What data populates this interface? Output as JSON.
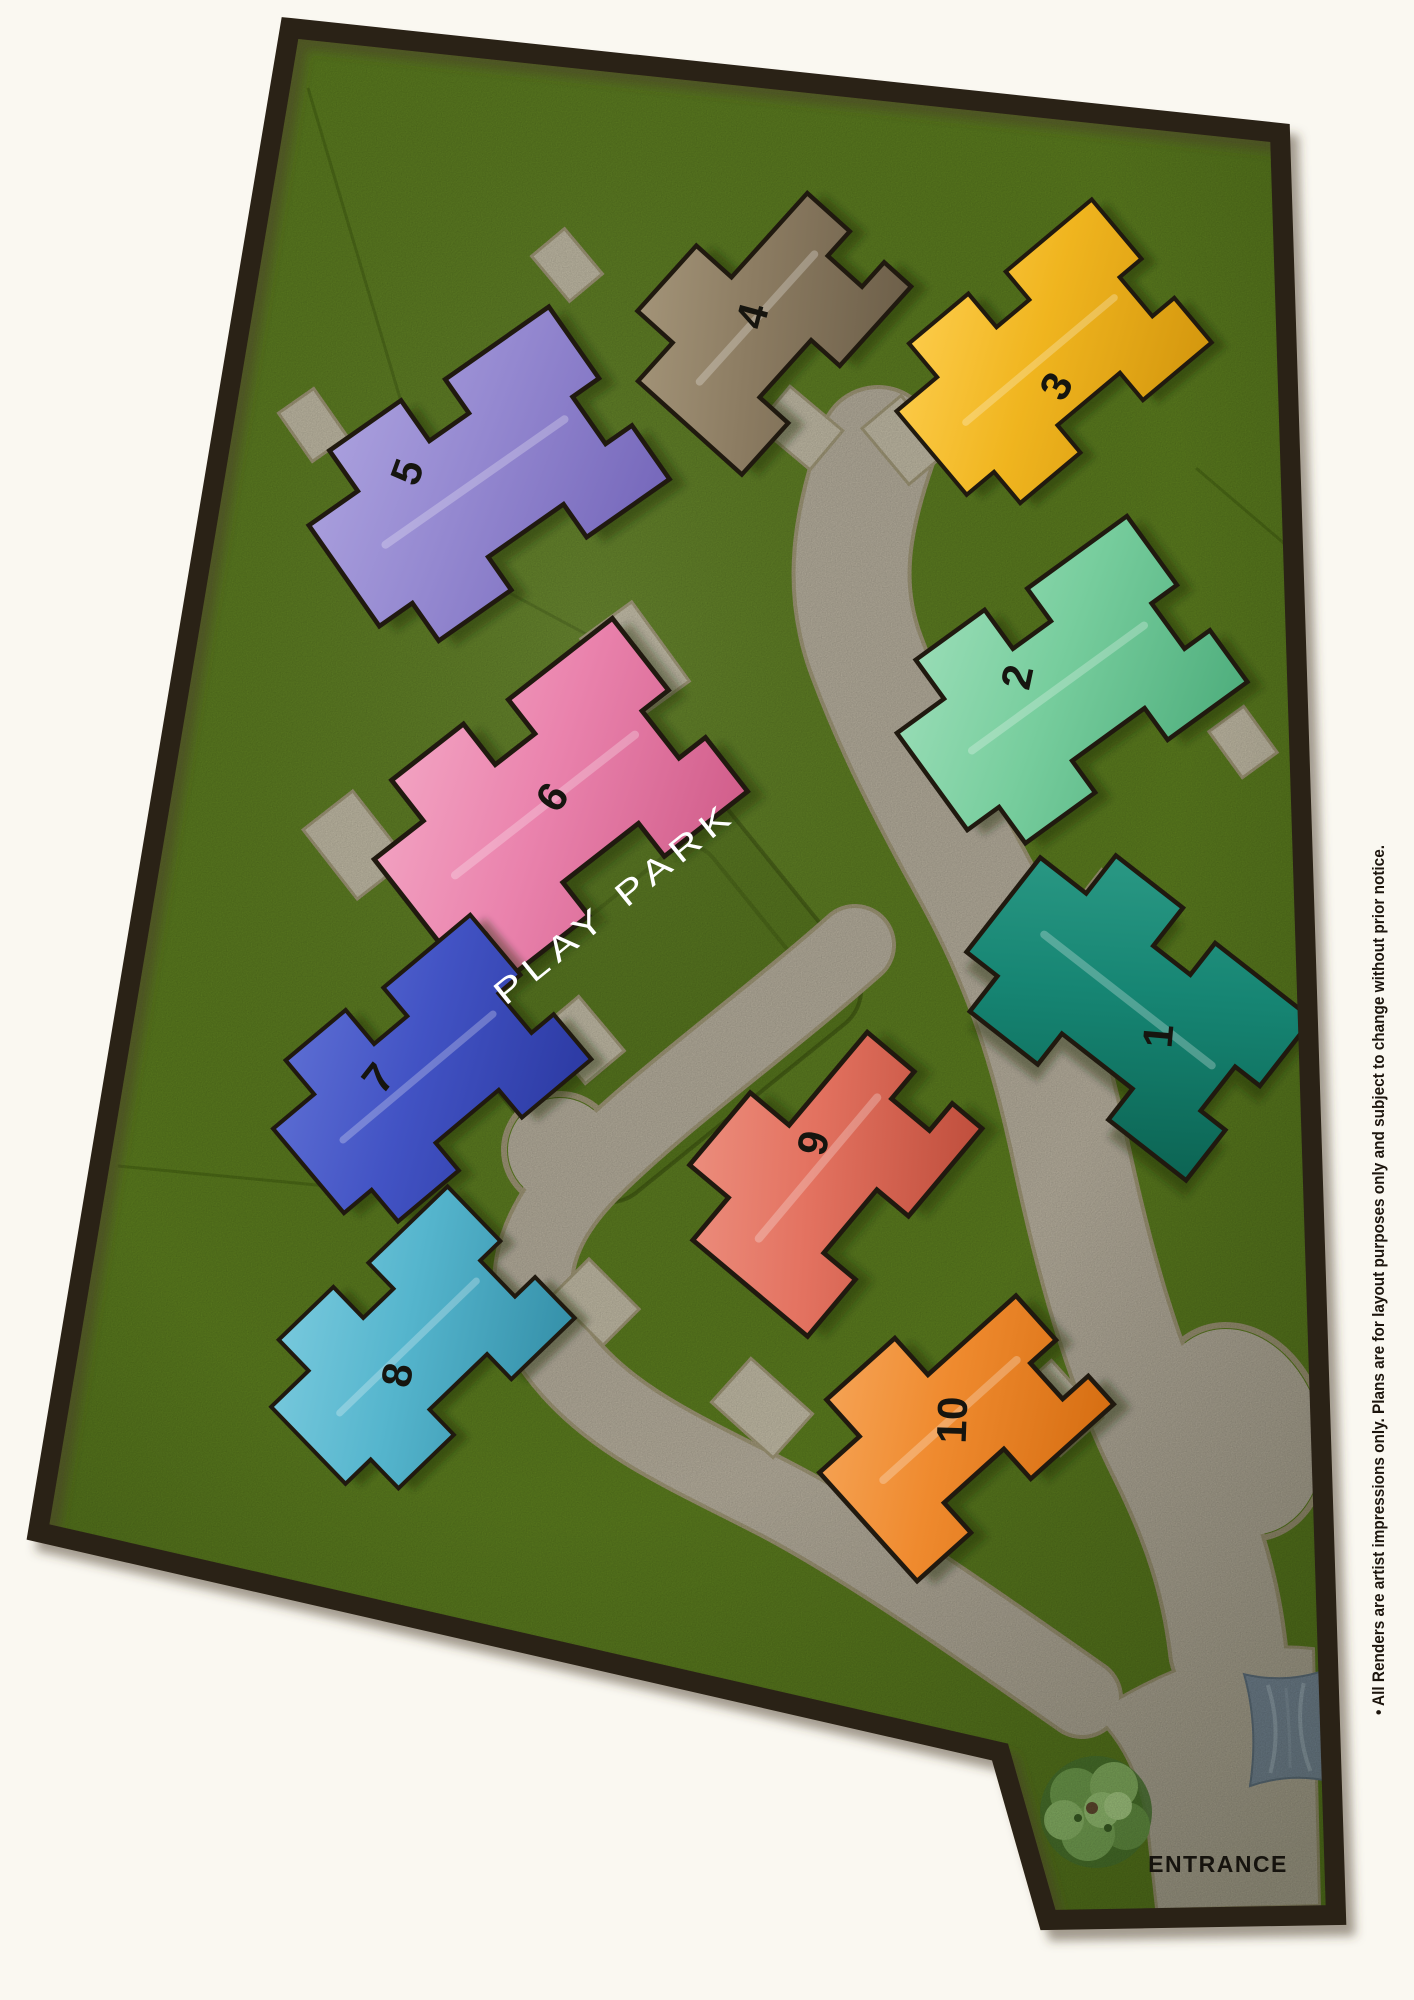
{
  "site": {
    "play_park_label": "PLAY PARK",
    "entrance_label": "ENTRANCE",
    "disclaimer": "• All Renders are artist impressions only. Plans are for layout purposes only and subject to change without prior notice.",
    "colors": {
      "background": "#faf8f1",
      "border": "#2b2116",
      "grass": "#5d7f1f",
      "road": "#bab2a0",
      "road_edge": "#a29978",
      "driveway": "#c6bfa9",
      "canopy": "#7e90a3",
      "number": "#16150f",
      "play_park_text": "#ffffff",
      "entrance_text": "#16130e"
    }
  },
  "houses": [
    {
      "number": "1",
      "color": "#168573",
      "light": "#2f9d88",
      "dark": "#0c6453",
      "cx": 1128,
      "cy": 1000,
      "rot": 38,
      "scale": 1.12,
      "template": "t1",
      "lx": 1158,
      "ly": 1036,
      "lrot": -85
    },
    {
      "number": "2",
      "color": "#77cd9d",
      "light": "#9fe0bb",
      "dark": "#4fae7d",
      "cx": 1058,
      "cy": 688,
      "rot": -36,
      "scale": 1.12,
      "template": "t1",
      "lx": 1017,
      "ly": 677,
      "lrot": -78
    },
    {
      "number": "3",
      "color": "#f0b51f",
      "light": "#ffd052",
      "dark": "#d4970e",
      "cx": 1040,
      "cy": 360,
      "rot": -40,
      "scale": 1.02,
      "template": "t1",
      "lx": 1056,
      "ly": 386,
      "lrot": -62
    },
    {
      "number": "4",
      "color": "#8c7c62",
      "light": "#a99a7e",
      "dark": "#6d5f49",
      "cx": 757,
      "cy": 318,
      "rot": -48,
      "scale": 1.1,
      "template": "t2",
      "lx": 752,
      "ly": 316,
      "lrot": -75
    },
    {
      "number": "5",
      "color": "#9488d0",
      "light": "#aea4e0",
      "dark": "#7668bb",
      "cx": 475,
      "cy": 482,
      "rot": -35,
      "scale": 1.15,
      "template": "t1",
      "lx": 407,
      "ly": 472,
      "lrot": -70
    },
    {
      "number": "6",
      "color": "#ea83ad",
      "light": "#f4a9c6",
      "dark": "#d15e8b",
      "cx": 545,
      "cy": 805,
      "rot": -38,
      "scale": 1.2,
      "template": "t1",
      "lx": 552,
      "ly": 797,
      "lrot": -56
    },
    {
      "number": "7",
      "color": "#4253c4",
      "light": "#6273d6",
      "dark": "#2c3aa3",
      "cx": 418,
      "cy": 1077,
      "rot": -40,
      "scale": 1.03,
      "template": "t1",
      "lx": 378,
      "ly": 1078,
      "lrot": -52
    },
    {
      "number": "8",
      "color": "#55b5cd",
      "light": "#7fcde0",
      "dark": "#3590a9",
      "cx": 408,
      "cy": 1347,
      "rot": -44,
      "scale": 1.0,
      "template": "t1",
      "lx": 397,
      "ly": 1375,
      "lrot": -80
    },
    {
      "number": "9",
      "color": "#e37260",
      "light": "#ee9484",
      "dark": "#bf4e3c",
      "cx": 818,
      "cy": 1168,
      "rot": -50,
      "scale": 1.18,
      "template": "t2",
      "lx": 813,
      "ly": 1143,
      "lrot": -78
    },
    {
      "number": "10",
      "color": "#ef8a2e",
      "light": "#f7a95e",
      "dark": "#d66e12",
      "cx": 950,
      "cy": 1420,
      "rot": -42,
      "scale": 1.15,
      "template": "t2",
      "lx": 952,
      "ly": 1420,
      "lrot": -88
    }
  ],
  "driveways": [
    {
      "x": 635,
      "y": 660,
      "w": 60,
      "h": 95,
      "rot": -36
    },
    {
      "x": 313,
      "y": 425,
      "w": 40,
      "h": 56,
      "rot": -35
    },
    {
      "x": 567,
      "y": 265,
      "w": 40,
      "h": 56,
      "rot": -40
    },
    {
      "x": 800,
      "y": 428,
      "w": 48,
      "h": 66,
      "rot": -50
    },
    {
      "x": 905,
      "y": 440,
      "w": 48,
      "h": 70,
      "rot": -40
    },
    {
      "x": 1243,
      "y": 742,
      "w": 40,
      "h": 54,
      "rot": -36
    },
    {
      "x": 1100,
      "y": 926,
      "w": 64,
      "h": 88,
      "rot": 38
    },
    {
      "x": 355,
      "y": 845,
      "w": 60,
      "h": 85,
      "rot": -38
    },
    {
      "x": 582,
      "y": 1040,
      "w": 48,
      "h": 68,
      "rot": -40
    },
    {
      "x": 596,
      "y": 1302,
      "w": 48,
      "h": 68,
      "rot": -45
    },
    {
      "x": 762,
      "y": 1408,
      "w": 56,
      "h": 80,
      "rot": -48
    },
    {
      "x": 1056,
      "y": 1408,
      "w": 54,
      "h": 74,
      "rot": -42
    }
  ]
}
